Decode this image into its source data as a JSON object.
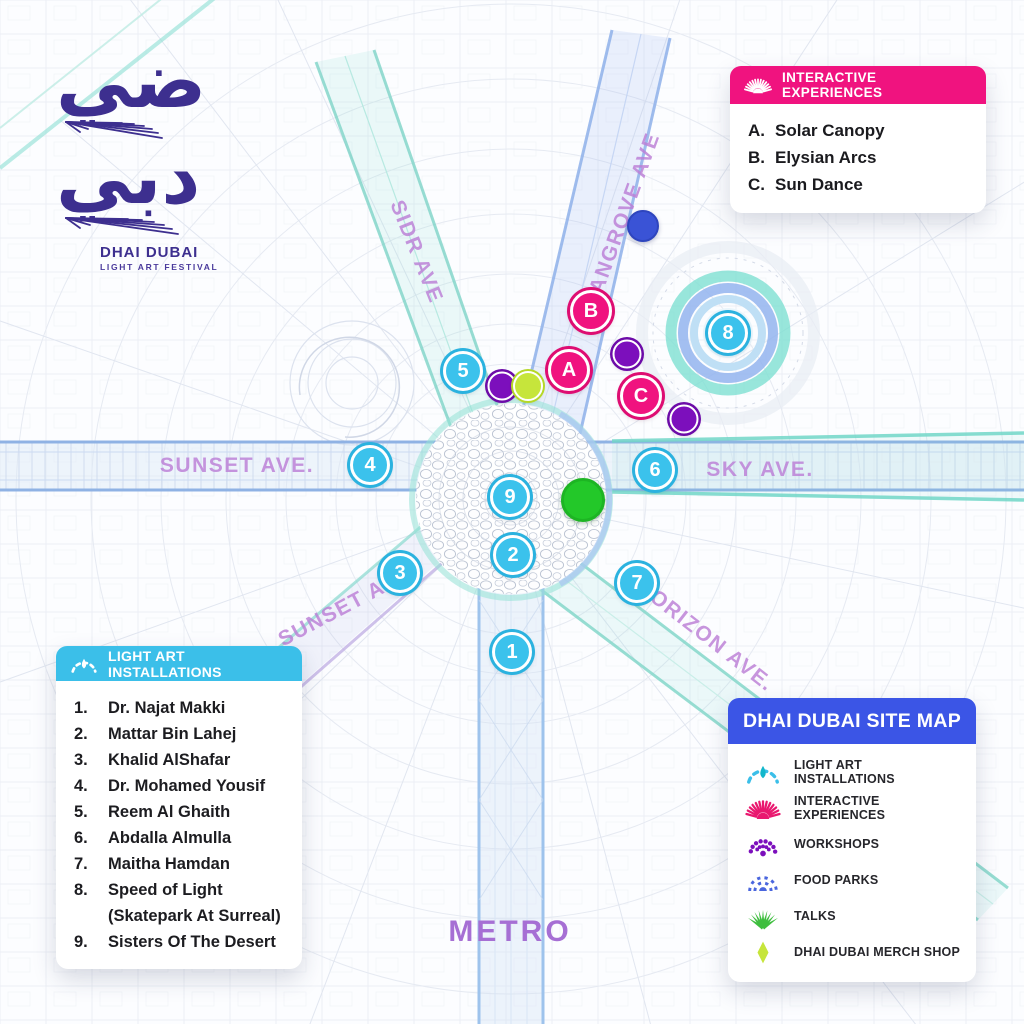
{
  "logo": {
    "arabic_top": "ضي",
    "arabic_bottom": "دبي",
    "title": "DHAI DUBAI",
    "subtitle": "LIGHT ART FESTIVAL"
  },
  "colors": {
    "installations": "#3BBFE9",
    "drop": "#12B7CB",
    "experiences": "#E9186F",
    "workshops": "#7C0FBC",
    "food_parks": "#4A66DE",
    "talks": "#3FBE3F",
    "merch": "#C6E53B",
    "header_pink": "#F0137F",
    "header_cyan": "#3BBFE9",
    "header_blue": "#3B55E6"
  },
  "panels": {
    "experiences": {
      "title": "INTERACTIVE EXPERIENCES",
      "items": [
        {
          "key": "A.",
          "label": "Solar Canopy"
        },
        {
          "key": "B.",
          "label": "Elysian Arcs"
        },
        {
          "key": "C.",
          "label": "Sun Dance"
        }
      ]
    },
    "installations": {
      "title": "LIGHT ART INSTALLATIONS",
      "items": [
        {
          "num": "1.",
          "label": "Dr. Najat Makki"
        },
        {
          "num": "2.",
          "label": "Mattar Bin Lahej"
        },
        {
          "num": "3.",
          "label": "Khalid AlShafar"
        },
        {
          "num": "4.",
          "label": "Dr. Mohamed Yousif"
        },
        {
          "num": "5.",
          "label": "Reem Al Ghaith"
        },
        {
          "num": "6.",
          "label": "Abdalla Almulla"
        },
        {
          "num": "7.",
          "label": "Maitha Hamdan"
        },
        {
          "num": "8.",
          "label": "Speed of Light",
          "sub": "(Skatepark At Surreal)"
        },
        {
          "num": "9.",
          "label": "Sisters Of The Desert"
        }
      ]
    },
    "sitemap": {
      "title": "DHAI DUBAI SITE MAP",
      "legend": [
        {
          "icon": "arc-drop",
          "label": "LIGHT ART INSTALLATIONS"
        },
        {
          "icon": "sunburst",
          "label": "INTERACTIVE EXPERIENCES"
        },
        {
          "icon": "dots-arc",
          "label": "WORKSHOPS"
        },
        {
          "icon": "dash-arc",
          "label": "FOOD PARKS"
        },
        {
          "icon": "fan",
          "label": "TALKS"
        },
        {
          "icon": "diamond",
          "label": "DHAI DUBAI MERCH SHOP"
        }
      ]
    }
  },
  "map": {
    "metro_label": "METRO",
    "avenues": [
      {
        "label": "SIDR AVE",
        "x": 416,
        "y": 252,
        "rotate": 68
      },
      {
        "label": "MANGROVE AVE",
        "x": 622,
        "y": 222,
        "rotate": -70
      },
      {
        "label": "SUNSET AVE.",
        "x": 237,
        "y": 466,
        "rotate": 0
      },
      {
        "label": "SKY AVE.",
        "x": 760,
        "y": 470,
        "rotate": 0
      },
      {
        "label": "SUNSET AVE",
        "x": 345,
        "y": 607,
        "rotate": -28
      },
      {
        "label": "HORIZON AVE.",
        "x": 705,
        "y": 636,
        "rotate": 38
      }
    ],
    "markers": [
      {
        "type": "cyan",
        "label": "1",
        "x": 512,
        "y": 652,
        "name": "marker-installation-1"
      },
      {
        "type": "cyan",
        "label": "2",
        "x": 513,
        "y": 555,
        "name": "marker-installation-2"
      },
      {
        "type": "cyan",
        "label": "3",
        "x": 400,
        "y": 573,
        "name": "marker-installation-3"
      },
      {
        "type": "cyan",
        "label": "4",
        "x": 370,
        "y": 465,
        "name": "marker-installation-4"
      },
      {
        "type": "cyan",
        "label": "5",
        "x": 463,
        "y": 371,
        "name": "marker-installation-5"
      },
      {
        "type": "cyan",
        "label": "6",
        "x": 655,
        "y": 470,
        "name": "marker-installation-6"
      },
      {
        "type": "cyan",
        "label": "7",
        "x": 637,
        "y": 583,
        "name": "marker-installation-7"
      },
      {
        "type": "cyan",
        "label": "8",
        "x": 728,
        "y": 333,
        "name": "marker-installation-8"
      },
      {
        "type": "cyan",
        "label": "9",
        "x": 510,
        "y": 497,
        "name": "marker-installation-9"
      },
      {
        "type": "pink",
        "label": "A",
        "x": 569,
        "y": 370,
        "name": "marker-experience-a"
      },
      {
        "type": "pink",
        "label": "B",
        "x": 591,
        "y": 311,
        "name": "marker-experience-b"
      },
      {
        "type": "pink",
        "label": "C",
        "x": 641,
        "y": 396,
        "name": "marker-experience-c"
      },
      {
        "type": "purple",
        "label": "",
        "x": 502,
        "y": 386,
        "name": "marker-workshop-1"
      },
      {
        "type": "purple",
        "label": "",
        "x": 627,
        "y": 354,
        "name": "marker-workshop-2"
      },
      {
        "type": "purple",
        "label": "",
        "x": 684,
        "y": 419,
        "name": "marker-workshop-3"
      },
      {
        "type": "lime",
        "label": "",
        "x": 528,
        "y": 386,
        "name": "marker-merch-shop"
      },
      {
        "type": "royal",
        "label": "",
        "x": 643,
        "y": 226,
        "name": "marker-food-park"
      },
      {
        "type": "green",
        "label": "",
        "x": 583,
        "y": 500,
        "name": "marker-talks"
      }
    ]
  }
}
